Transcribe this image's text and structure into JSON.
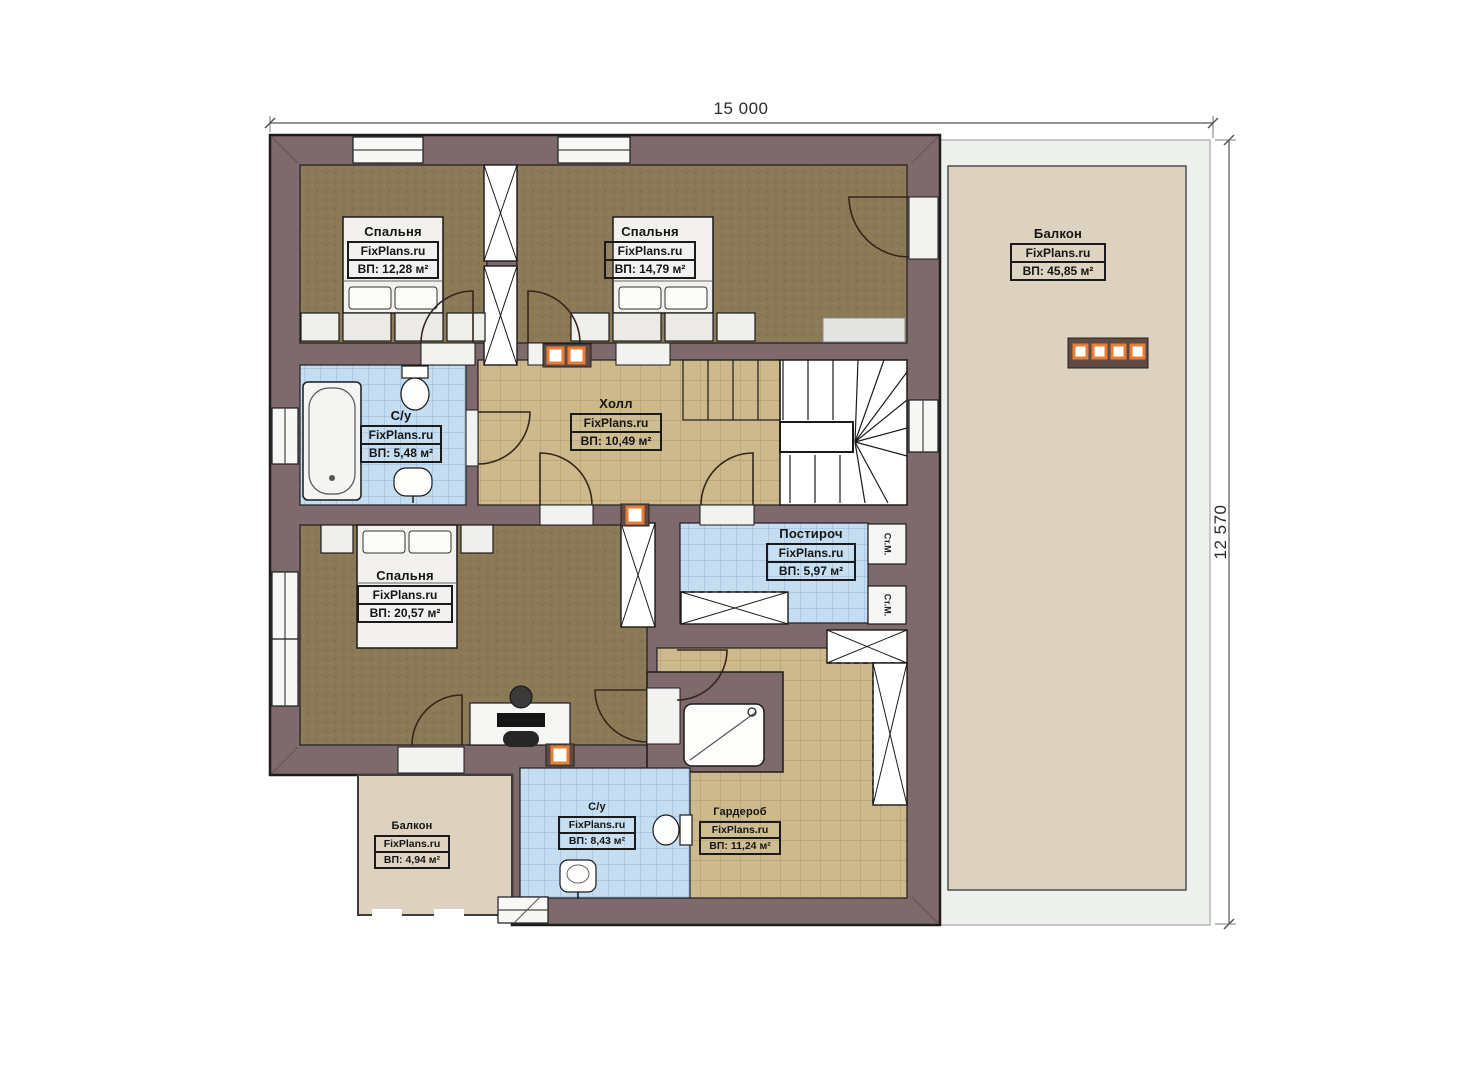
{
  "plan": {
    "brand": "FixPlans.ru",
    "dim_width": "15 000",
    "dim_height": "12 570"
  },
  "rooms": {
    "bedroom1": {
      "name": "Спальня",
      "brand": "FixPlans.ru",
      "area": "ВП: 12,28 м²"
    },
    "bedroom2": {
      "name": "Спальня",
      "brand": "FixPlans.ru",
      "area": "ВП: 14,79 м²"
    },
    "balcony_large": {
      "name": "Балкон",
      "brand": "FixPlans.ru",
      "area": "ВП: 45,85 м²"
    },
    "bath_small": {
      "name": "С/у",
      "brand": "FixPlans.ru",
      "area": "ВП: 5,48 м²"
    },
    "hall": {
      "name": "Холл",
      "brand": "FixPlans.ru",
      "area": "ВП: 10,49 м²"
    },
    "bedroom3": {
      "name": "Спальня",
      "brand": "FixPlans.ru",
      "area": "ВП: 20,57 м²"
    },
    "laundry": {
      "name": "Постироч",
      "brand": "FixPlans.ru",
      "area": "ВП: 5,97 м²"
    },
    "balcony_small": {
      "name": "Балкон",
      "brand": "FixPlans.ru",
      "area": "ВП: 4,94 м²"
    },
    "bath_large": {
      "name": "С/у",
      "brand": "FixPlans.ru",
      "area": "ВП: 8,43 м²"
    },
    "wardrobe": {
      "name": "Гардероб",
      "brand": "FixPlans.ru",
      "area": "ВП: 11,24 м²"
    }
  },
  "appliances": {
    "washer_label": "Ст.М."
  },
  "colors": {
    "wall": "#7e6a6c",
    "carpet": "#8b7a55",
    "tile_beige": "#cdb98c",
    "tile_blue": "#c5ddf1",
    "balcony_floor": "#ddd2bf",
    "terrace_gray": "#eef0ee",
    "accent_orange": "#e87e36"
  }
}
